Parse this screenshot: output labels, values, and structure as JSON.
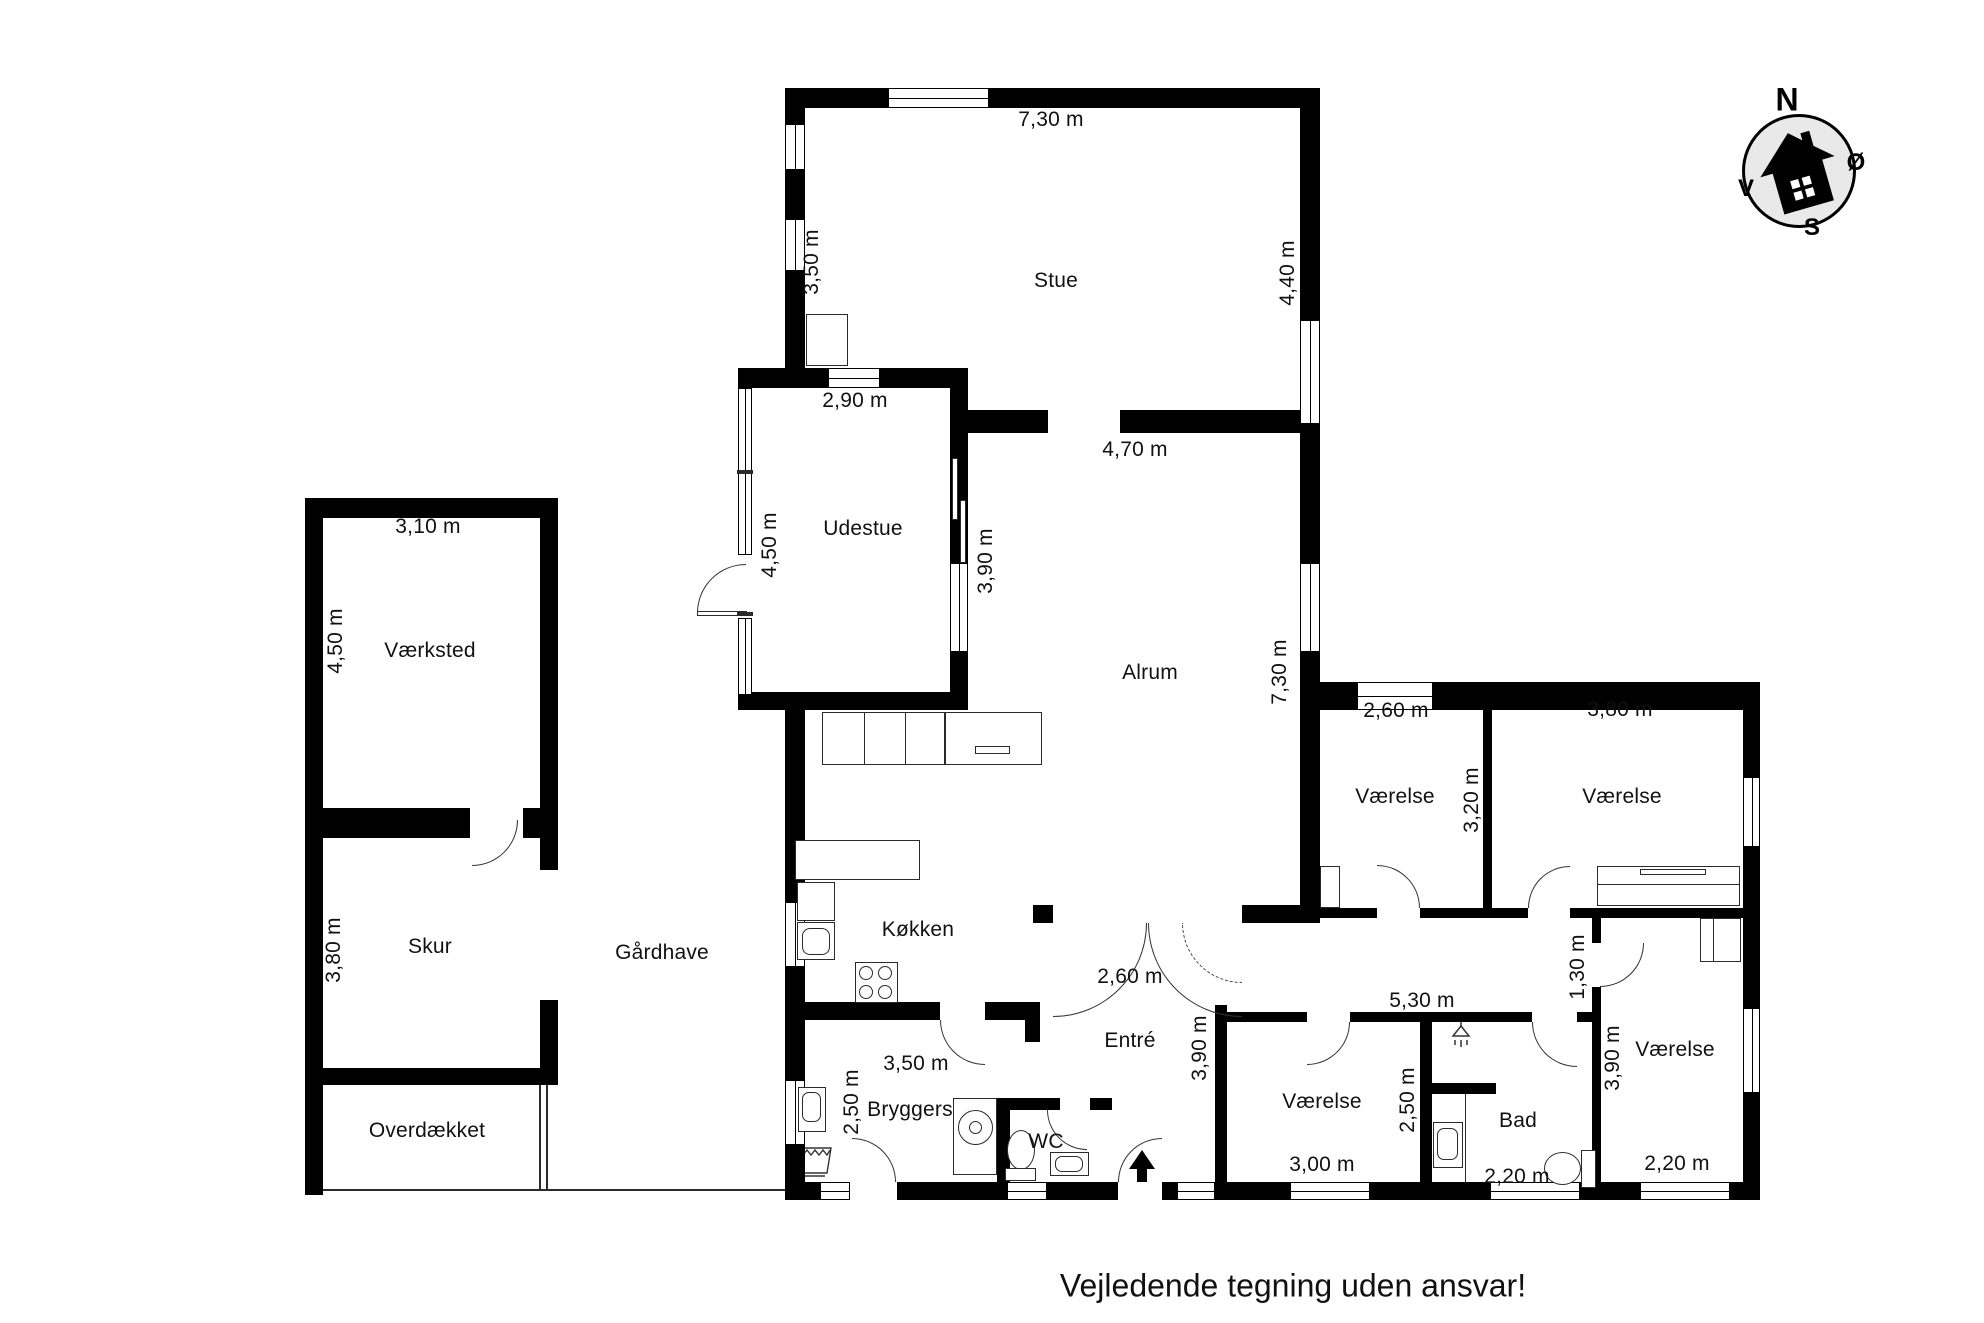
{
  "plan": {
    "disclaimer": "Vejledende tegning uden ansvar!",
    "oven_label": "OVN",
    "compass": {
      "north": "N",
      "east": "Ø",
      "south": "S",
      "west": "V"
    },
    "rooms": [
      {
        "name": "Stue",
        "cx": 1056,
        "cy": 281
      },
      {
        "name": "Udestue",
        "cx": 863,
        "cy": 529
      },
      {
        "name": "Alrum",
        "cx": 1150,
        "cy": 673
      },
      {
        "name": "Værksted",
        "cx": 430,
        "cy": 651
      },
      {
        "name": "Skur",
        "cx": 430,
        "cy": 947
      },
      {
        "name": "Gårdhave",
        "cx": 662,
        "cy": 953
      },
      {
        "name": "Overdækket",
        "cx": 427,
        "cy": 1131
      },
      {
        "name": "Køkken",
        "cx": 918,
        "cy": 930
      },
      {
        "name": "Bryggers",
        "cx": 910,
        "cy": 1110
      },
      {
        "name": "WC",
        "cx": 1046,
        "cy": 1142
      },
      {
        "name": "Entré",
        "cx": 1130,
        "cy": 1041
      },
      {
        "name": "Værelse",
        "cx": 1395,
        "cy": 797
      },
      {
        "name": "Værelse",
        "cx": 1622,
        "cy": 797
      },
      {
        "name": "Værelse",
        "cx": 1322,
        "cy": 1102
      },
      {
        "name": "Bad",
        "cx": 1518,
        "cy": 1121
      },
      {
        "name": "Værelse",
        "cx": 1675,
        "cy": 1050
      }
    ],
    "dimensions": [
      {
        "text": "7,30 m",
        "cx": 1051,
        "cy": 120,
        "vertical": false
      },
      {
        "text": "3,50 m",
        "cx": 812,
        "cy": 262,
        "vertical": true
      },
      {
        "text": "4,40 m",
        "cx": 1288,
        "cy": 273,
        "vertical": true
      },
      {
        "text": "2,90 m",
        "cx": 855,
        "cy": 401,
        "vertical": false
      },
      {
        "text": "4,70 m",
        "cx": 1135,
        "cy": 450,
        "vertical": false
      },
      {
        "text": "4,50 m",
        "cx": 770,
        "cy": 545,
        "vertical": true
      },
      {
        "text": "3,90 m",
        "cx": 986,
        "cy": 561,
        "vertical": true
      },
      {
        "text": "7,30 m",
        "cx": 1280,
        "cy": 672,
        "vertical": true
      },
      {
        "text": "3,10 m",
        "cx": 428,
        "cy": 527,
        "vertical": false
      },
      {
        "text": "4,50 m",
        "cx": 336,
        "cy": 641,
        "vertical": true
      },
      {
        "text": "3,80 m",
        "cx": 334,
        "cy": 950,
        "vertical": true
      },
      {
        "text": "2,60 m",
        "cx": 1396,
        "cy": 711,
        "vertical": false
      },
      {
        "text": "3,20 m",
        "cx": 1472,
        "cy": 800,
        "vertical": true
      },
      {
        "text": "3,80 m",
        "cx": 1620,
        "cy": 710,
        "vertical": false
      },
      {
        "text": "5,30 m",
        "cx": 1422,
        "cy": 1001,
        "vertical": false
      },
      {
        "text": "1,30 m",
        "cx": 1578,
        "cy": 967,
        "vertical": true
      },
      {
        "text": "2,60 m",
        "cx": 1130,
        "cy": 977,
        "vertical": false
      },
      {
        "text": "3,90 m",
        "cx": 1200,
        "cy": 1048,
        "vertical": true
      },
      {
        "text": "3,50 m",
        "cx": 916,
        "cy": 1064,
        "vertical": false
      },
      {
        "text": "2,50 m",
        "cx": 852,
        "cy": 1102,
        "vertical": true
      },
      {
        "text": "3,00 m",
        "cx": 1322,
        "cy": 1165,
        "vertical": false
      },
      {
        "text": "2,50 m",
        "cx": 1408,
        "cy": 1100,
        "vertical": true
      },
      {
        "text": "2,20 m",
        "cx": 1517,
        "cy": 1177,
        "vertical": false
      },
      {
        "text": "3,90 m",
        "cx": 1613,
        "cy": 1058,
        "vertical": true
      },
      {
        "text": "2,20 m",
        "cx": 1677,
        "cy": 1164,
        "vertical": false
      }
    ],
    "colors": {
      "wall": "#000000",
      "background": "#ffffff",
      "compass_fill": "#e9e9e9"
    },
    "icons": [
      "compass-rose-icon",
      "house-icon",
      "flame-icon",
      "snowflake-icon",
      "dishwasher-icon",
      "sink-icon",
      "stove-icon",
      "oven-icon",
      "washing-machine-icon",
      "laundry-basket-icon",
      "toilet-icon",
      "shower-icon",
      "entrance-arrow-icon"
    ]
  }
}
